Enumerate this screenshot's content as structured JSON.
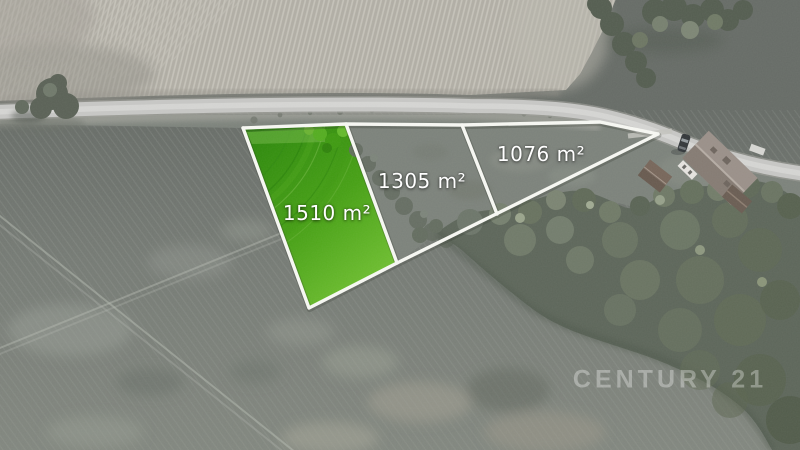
{
  "parcels": [
    {
      "area": "1510 m²",
      "highlighted": true
    },
    {
      "area": "1305 m²",
      "highlighted": false
    },
    {
      "area": "1076 m²",
      "highlighted": false
    }
  ],
  "watermark": {
    "text": "CENTURY 21"
  },
  "colors": {
    "highlight_green": "#46a014",
    "boundary_line": "#f7f8f3",
    "label_text": "#ffffff",
    "watermark_text": "rgba(255,255,255,0.32)"
  }
}
